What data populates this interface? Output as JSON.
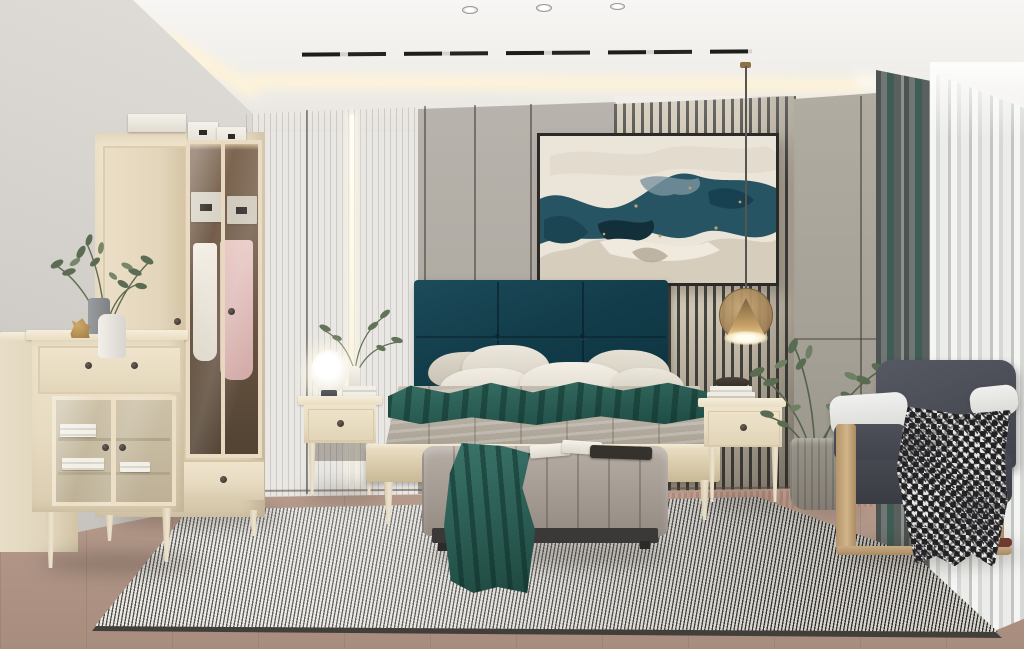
{
  "meta": {
    "type": "interior-photograph",
    "subject": "modern-bedroom-showroom"
  },
  "description": "Photorealistic render of a modern bedroom: pale ash-wood furniture set (glass-door wardrobe, dresser, bed, nightstands, bench), dark teal upholstered headboard, abstract teal artwork on a slatted accent wall, brass cone pendant, globe table lamp, gray armchair with houndstooth throw, potted greenery, striped woven rug on pink-toned wood floor, gray and sheer curtains on the right window wall, tray ceiling with cove lighting and black track lights.",
  "objects": [
    {
      "name": "ceiling-cove-lighting"
    },
    {
      "name": "track-lights"
    },
    {
      "name": "recessed-downlights"
    },
    {
      "name": "abstract-artwork"
    },
    {
      "name": "slat-accent-wall"
    },
    {
      "name": "led-wall-strip"
    },
    {
      "name": "wardrobe"
    },
    {
      "name": "storage-boxes"
    },
    {
      "name": "dresser"
    },
    {
      "name": "side-cabinet"
    },
    {
      "name": "vase-plant"
    },
    {
      "name": "horse-figurine"
    },
    {
      "name": "left-nightstand"
    },
    {
      "name": "globe-table-lamp"
    },
    {
      "name": "bed"
    },
    {
      "name": "teal-headboard"
    },
    {
      "name": "pillows"
    },
    {
      "name": "teal-blanket"
    },
    {
      "name": "right-nightstand"
    },
    {
      "name": "brass-pendant-lamp"
    },
    {
      "name": "book-stack"
    },
    {
      "name": "bench"
    },
    {
      "name": "open-book"
    },
    {
      "name": "teal-throw"
    },
    {
      "name": "potted-plant"
    },
    {
      "name": "armchair"
    },
    {
      "name": "houndstooth-throw"
    },
    {
      "name": "striped-rug"
    },
    {
      "name": "gray-curtain"
    },
    {
      "name": "sheer-curtain"
    }
  ],
  "palette": {
    "cove_glow": "#fff3d8",
    "slat_light": "#cec4b2",
    "slat_dark": "#45443f",
    "headboard": "#133d4b",
    "blanket_teal": "#2c6358",
    "throw_teal": "#2e6459",
    "bench_base": "#3b3937",
    "chair_dark": "#4a4d55",
    "curtain_teal": "#3f5c55",
    "rug_light": "#e6e3dc",
    "rug_dark": "#33322f",
    "frame_dark": "#2b2a27"
  }
}
